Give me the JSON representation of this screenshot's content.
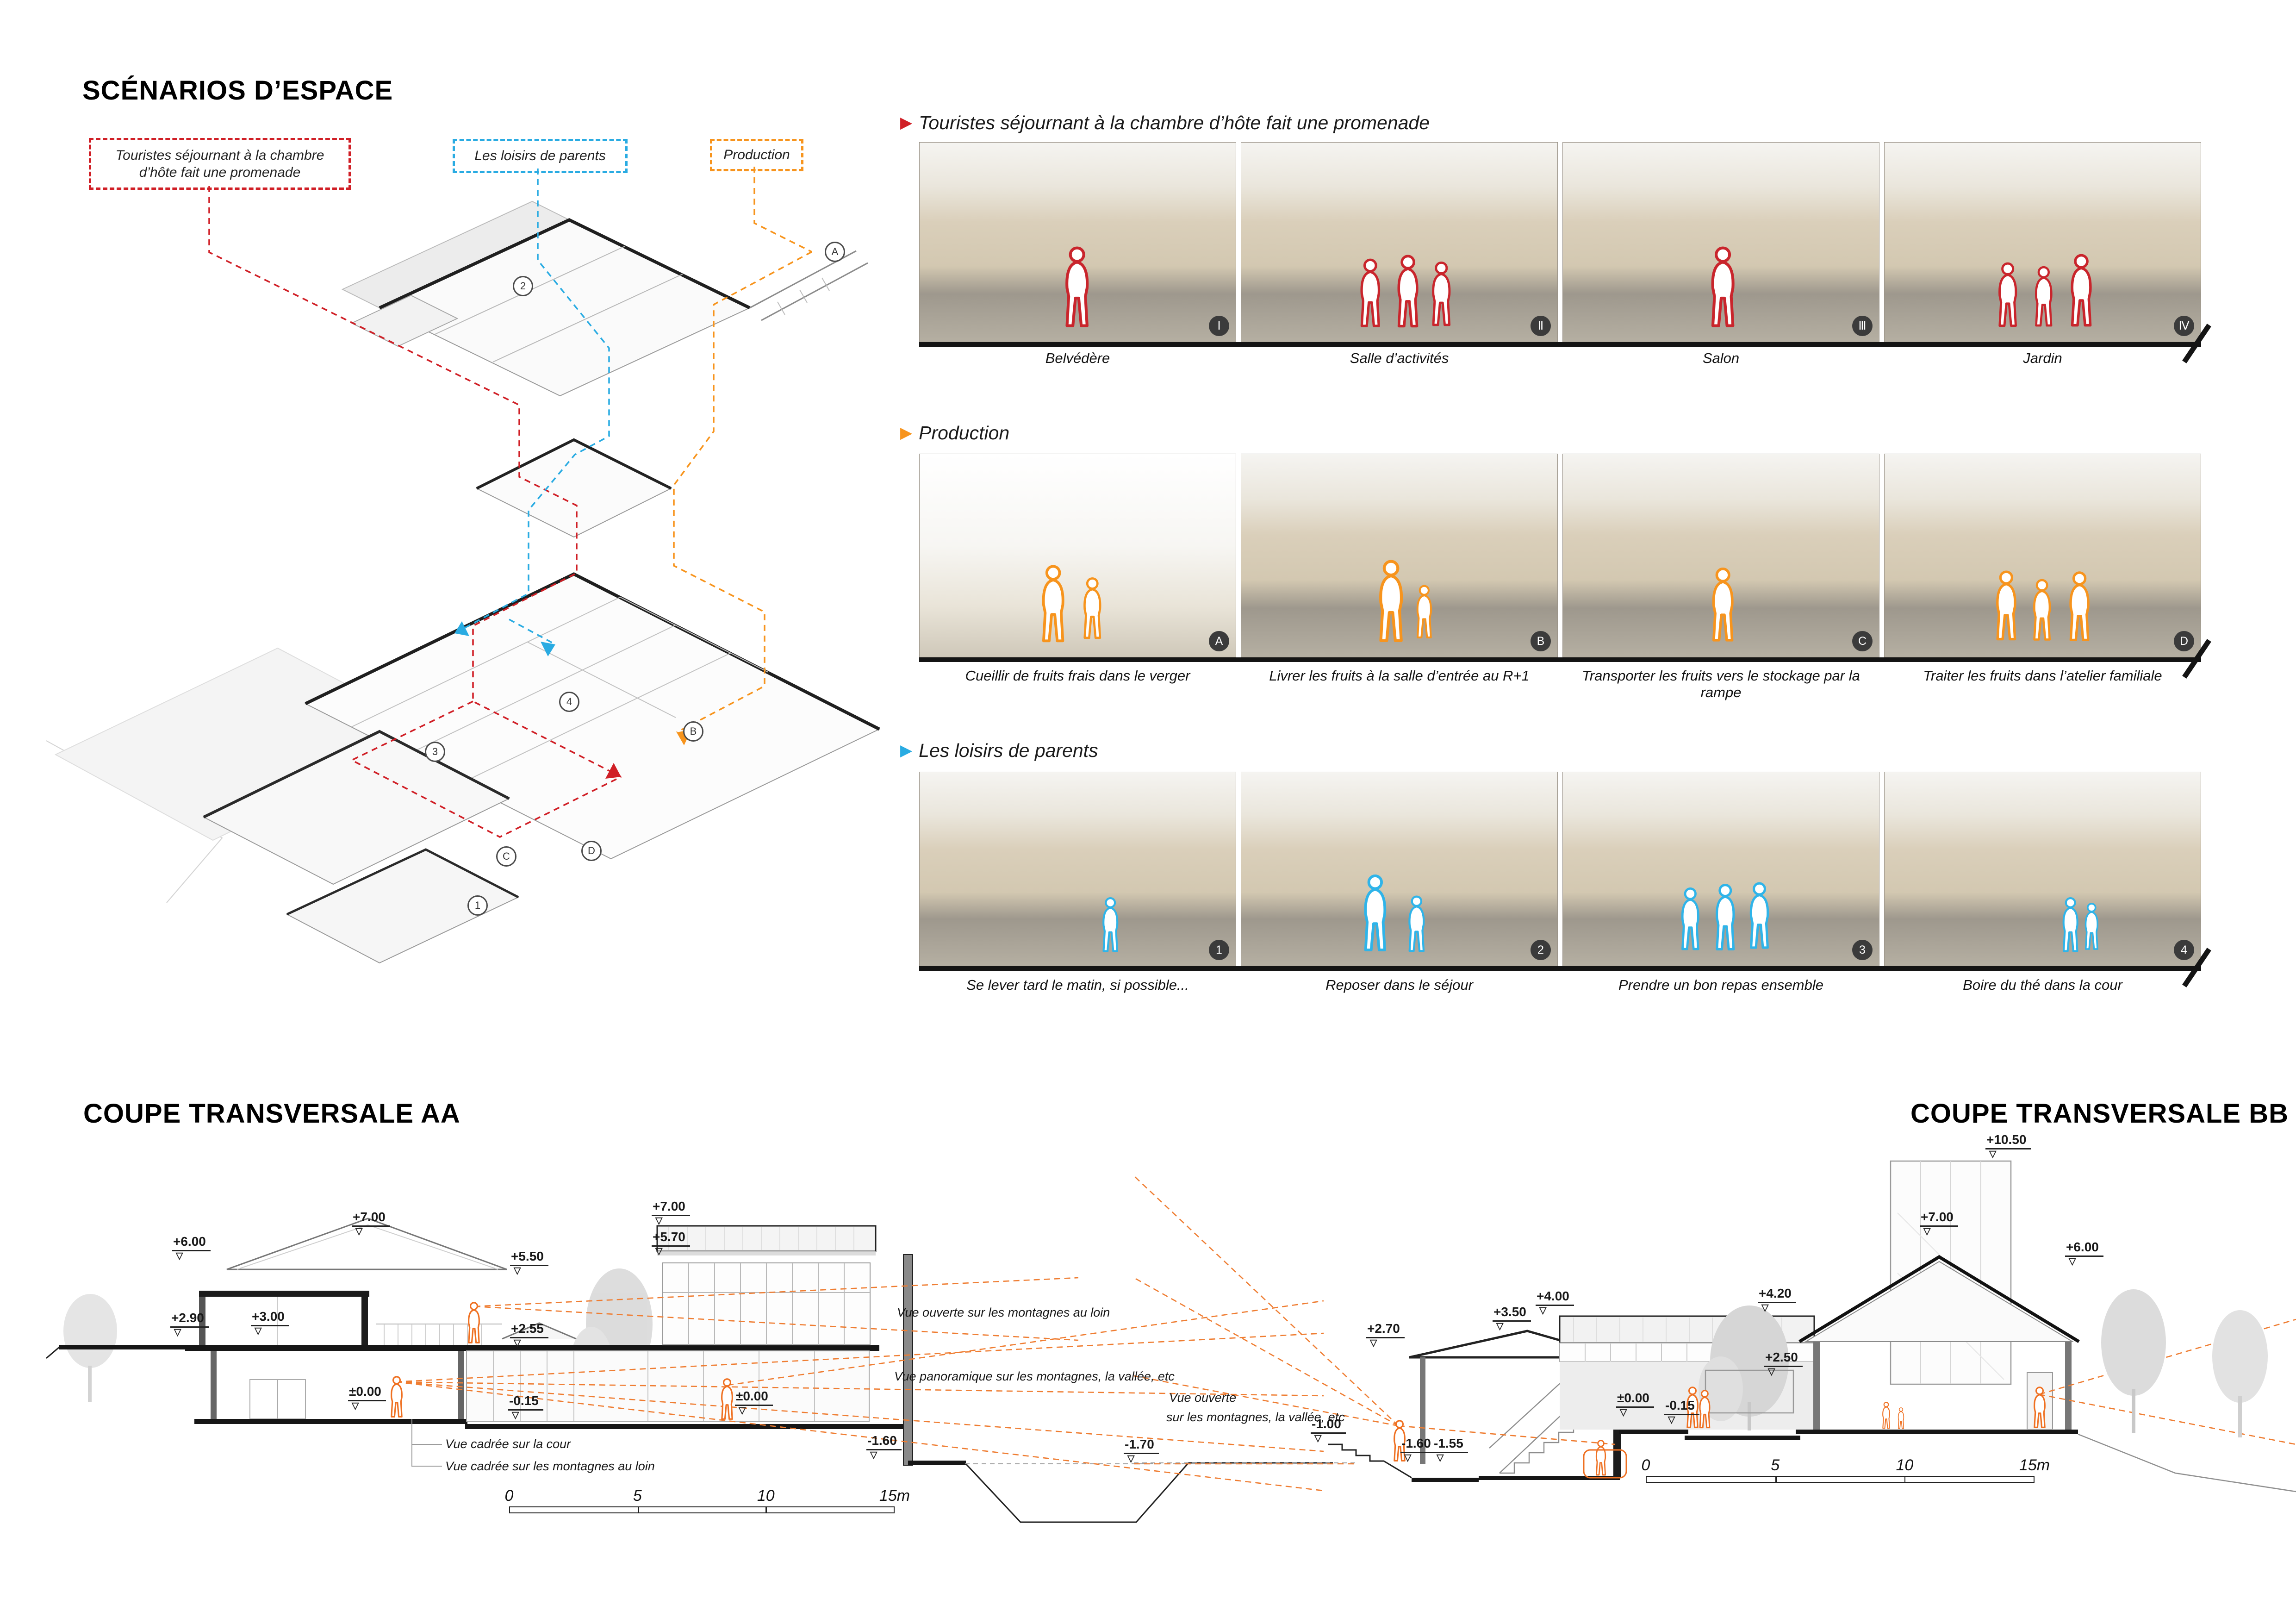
{
  "page": {
    "title": "SCÉNARIOS D’ESPACE"
  },
  "legend": {
    "tourists": "Touristes séjournant à la chambre d’hôte fait une promenade",
    "leisure": "Les loisirs de parents",
    "production": "Production"
  },
  "colors": {
    "red": "#d01f26",
    "blue": "#29abe2",
    "orange": "#f7941d"
  },
  "axon": {
    "markers": {
      "m1": "2",
      "m2": "A",
      "m3": "3",
      "m4": "B",
      "m5": "1",
      "m6": "C",
      "m7": "D",
      "m8": "4"
    }
  },
  "scenarios": [
    {
      "title": "Touristes séjournant à la chambre d’hôte fait une promenade",
      "frames": [
        {
          "caption": "Belvédère",
          "marker": "Ⅰ"
        },
        {
          "caption": "Salle d’activités",
          "marker": "Ⅱ"
        },
        {
          "caption": "Salon",
          "marker": "Ⅲ"
        },
        {
          "caption": "Jardin",
          "marker": "Ⅳ"
        }
      ]
    },
    {
      "title": "Production",
      "frames": [
        {
          "caption": "Cueillir de fruits frais dans le verger",
          "marker": "A"
        },
        {
          "caption": "Livrer les fruits à la salle d’entrée au R+1",
          "marker": "B"
        },
        {
          "caption": "Transporter les fruits vers le stockage par la rampe",
          "marker": "C"
        },
        {
          "caption": "Traiter les fruits dans l’atelier familiale",
          "marker": "D"
        }
      ]
    },
    {
      "title": "Les loisirs de parents",
      "frames": [
        {
          "caption": "Se lever tard le matin, si possible...",
          "marker": "1"
        },
        {
          "caption": "Reposer dans le séjour",
          "marker": "2"
        },
        {
          "caption": "Prendre un bon repas ensemble",
          "marker": "3"
        },
        {
          "caption": "Boire du thé dans la cour",
          "marker": "4"
        }
      ]
    }
  ],
  "sections": {
    "aa": {
      "title": "COUPE TRANSVERSALE AA",
      "levels": [
        "+7.00",
        "+6.00",
        "+5.50",
        "+2.90",
        "+3.00",
        "+2.55",
        "±0.00",
        "-0.15",
        "±0.00",
        "+7.00",
        "+5.70",
        "-1.60",
        "-1.70"
      ],
      "notes": [
        "Vue ouverte sur les montagnes  au loin",
        "Vue panoramique sur les montagnes, la vallée, etc",
        "Vue cadrée sur la cour",
        "Vue cadrée sur les montagnes au loin"
      ],
      "scale": [
        "0",
        "5",
        "10",
        "15m"
      ]
    },
    "bb": {
      "title": "COUPE TRANSVERSALE BB",
      "levels": [
        "+10.50",
        "+7.00",
        "+6.00",
        "+4.00",
        "+4.20",
        "+3.50",
        "+2.70",
        "+2.50",
        "±0.00",
        "-0.15",
        "-1.00",
        "-1.60",
        "-1.55"
      ],
      "note_line1": "Vue ouverte",
      "note_line2": "sur les montagnes, la vallée, etc",
      "scale": [
        "0",
        "5",
        "10",
        "15m"
      ]
    }
  }
}
